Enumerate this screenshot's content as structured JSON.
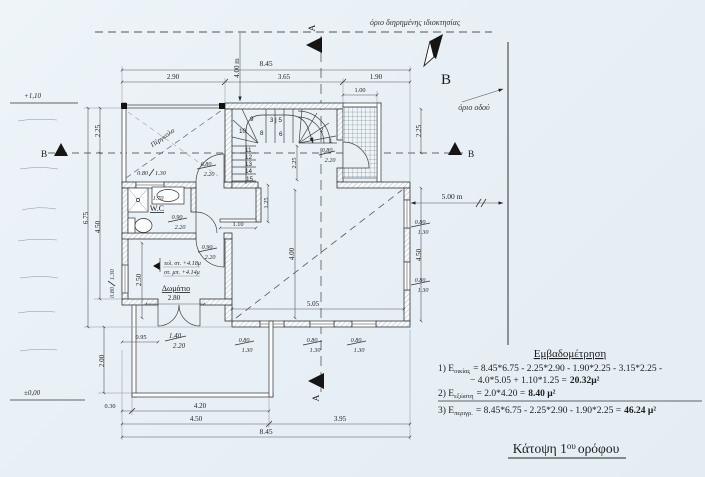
{
  "page": {
    "title_t1": "Κάτοψη 1",
    "title_sup": "ου",
    "title_t2": "ορόφου"
  },
  "boundaries": {
    "property": "όριο διηρημένης ιδιοκτησίας",
    "road": "όριο οδού"
  },
  "markers": {
    "north": "B",
    "a_top": "A",
    "a_bottom": "A",
    "b_left": "B",
    "b_right": "B"
  },
  "levels": {
    "upper": "+1,10",
    "ground": "±0,00",
    "floor_fin": "τελ. στ. +4.18μ",
    "floor_str": "στ. μπ. +4.14μ"
  },
  "rooms": {
    "pergola": "Πέργκολα",
    "wc": "W.C",
    "wc_dim": "1.70",
    "bedroom": "Δωμάτιο"
  },
  "dims": {
    "top_total": "8.45",
    "top_a": "2.90",
    "top_b": "3.65",
    "top_c": "1.90",
    "top_balcony": "1.00",
    "setback": "4.00 m",
    "left_a": "2.25",
    "left_total": "6.75",
    "left_b": "4.50",
    "left_c": "2.00",
    "right_a": "2.25",
    "right_offset": "5.00 m",
    "right_b": "4.50",
    "bottom_a": "0.30",
    "bottom_b": "4.20",
    "bottom_c": "4.50",
    "bottom_d": "3.95",
    "bottom_total": "8.45",
    "stair_landing": "1.25",
    "stair_width": "1.10",
    "stair_mid": "2.25",
    "room_w": "2.80",
    "room_h": "2.50",
    "door_offset": "0.95",
    "main_w": "5.05",
    "main_h": "4.00"
  },
  "openings": {
    "wc_window": {
      "w": "0.80",
      "h": "1.30"
    },
    "pergola_door": {
      "w": "0.80",
      "h": "2.20"
    },
    "wc_door": {
      "w": "0.90",
      "h": "2.20"
    },
    "room_door": {
      "w": "0.90",
      "h": "2.20"
    },
    "balcony_door": {
      "w": "1.40",
      "h": "2.20"
    },
    "stair_balcony_door": {
      "w": "0.80",
      "h": "2.20"
    },
    "south_window_1": {
      "w": "0.80",
      "h": "1.30"
    },
    "south_window_2": {
      "w": "0.80",
      "h": "1.30"
    },
    "south_window_3": {
      "w": "0.80",
      "h": "1.30"
    },
    "east_window_1": {
      "w": "0.80",
      "h": "1.30"
    },
    "east_window_2": {
      "w": "0.80",
      "h": "1.30"
    },
    "west_window": {
      "w": "0.80",
      "h": "1.30"
    }
  },
  "stairs": {
    "n1": "1",
    "n2": "2",
    "n35": "3 | 5",
    "n6": "6",
    "n8": "8",
    "n9": "9",
    "n10": "10",
    "n11": "11",
    "n12": "12",
    "n13": "13",
    "n14": "14",
    "n15": "15"
  },
  "area_block": {
    "heading": "Εμβαδομέτρηση",
    "l1_prefix": "1) E",
    "l1_sub": "οικίας",
    "l1_body": "= 8.45*6.75 - 2.25*2.90 - 1.90*2.25 - 3.15*2.25 -",
    "l1b_body": "− 4.0*5.05 + 1.10*1.25 =",
    "l1b_result": "20.32μ²",
    "l2_prefix": "2) E",
    "l2_sub": "εξώστη",
    "l2_body": "= 2.0*4.20 =",
    "l2_result": "8.40 μ²",
    "l3_prefix": "3) E",
    "l3_sub": "περιγρ.",
    "l3_body": "= 8.45*6.75 - 2.25*2.90 - 1.90*2.25 =",
    "l3_result": "46.24 μ²"
  }
}
